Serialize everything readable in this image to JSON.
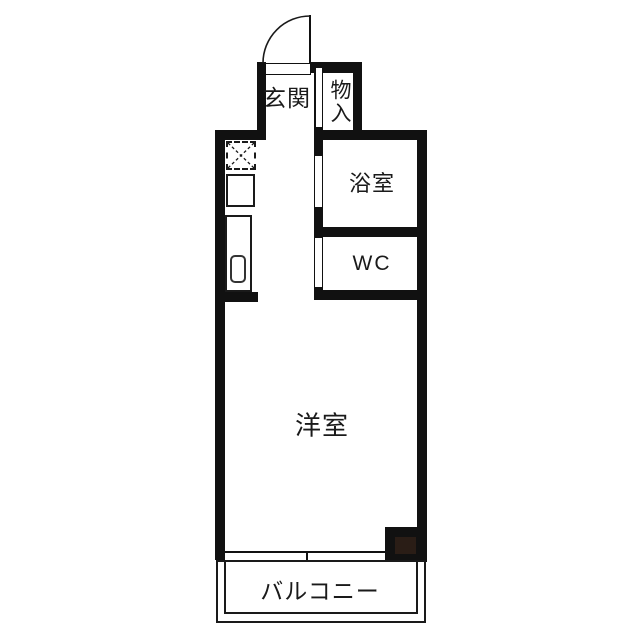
{
  "plan_title": "floor-plan",
  "rooms": {
    "genkan": {
      "label": "玄関"
    },
    "storage": {
      "label": "物入"
    },
    "bathroom": {
      "label": "浴室"
    },
    "toilet": {
      "label": "WC"
    },
    "main_room": {
      "label": "洋室"
    },
    "balcony": {
      "label": "バルコニー"
    }
  },
  "fixtures": {
    "entrance_door": "swing-door",
    "refrigerator_space": "dashed-box-x",
    "kitchen_unit": "counter-with-sink",
    "window": "sliding-window",
    "pillar": "column"
  },
  "colors": {
    "wall": "#111111",
    "line": "#1a1a1a",
    "pillar_fill": "#2a1d16",
    "background": "#ffffff",
    "text": "#1a1a1a"
  }
}
